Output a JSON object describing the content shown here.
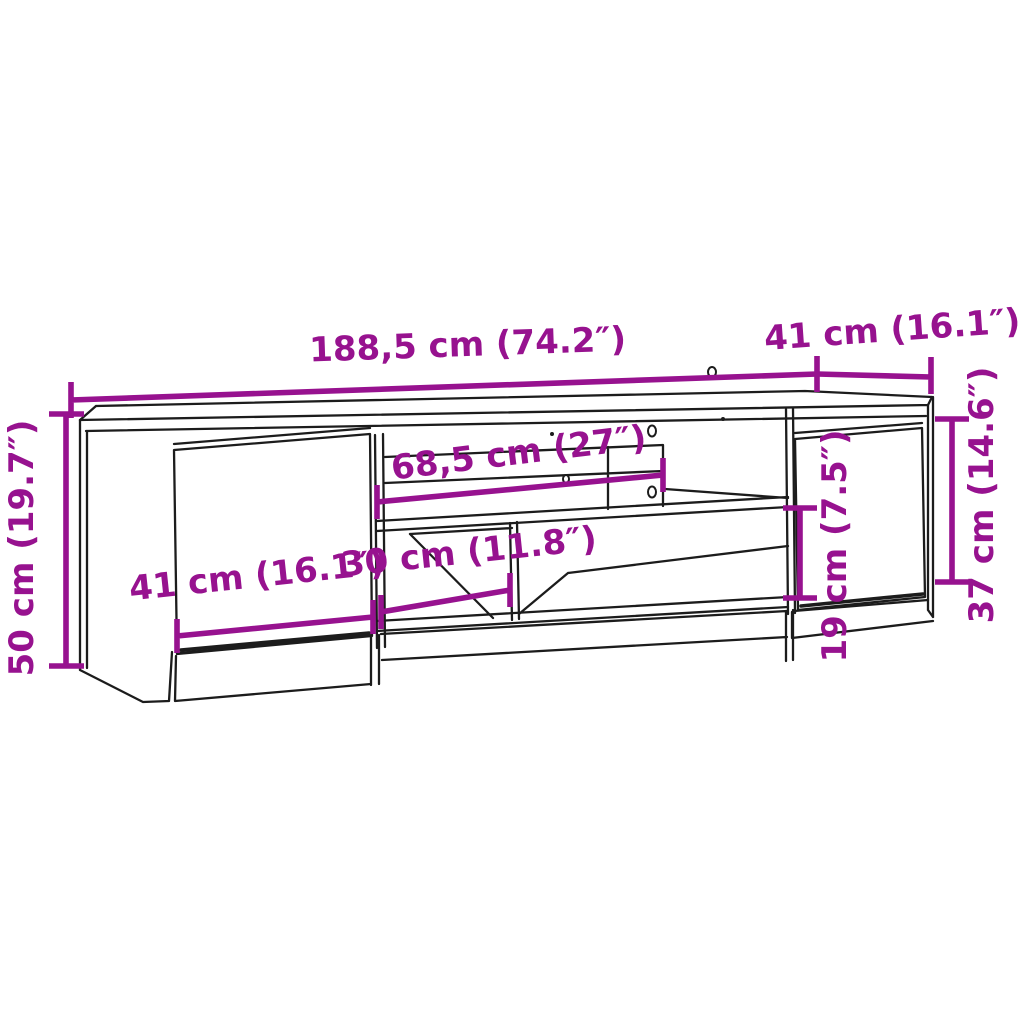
{
  "colors": {
    "background": "#ffffff",
    "outline": "#1c1c1c",
    "dimension": "#97128f"
  },
  "dimensions": {
    "overall_width": {
      "label": "188,5 cm (74.2″)"
    },
    "depth": {
      "label": "41 cm (16.1″)"
    },
    "overall_height": {
      "label": "50 cm (19.7″)"
    },
    "middle_shelf_width": {
      "label": "68,5 cm (27″)"
    },
    "door_width": {
      "label": "41 cm (16.1″)"
    },
    "open_compartment_width": {
      "label": "30 cm (11.8″)"
    },
    "open_compartment_height": {
      "label": "19 cm (7.5″)"
    },
    "door_height": {
      "label": "37 cm (14.6″)"
    }
  }
}
